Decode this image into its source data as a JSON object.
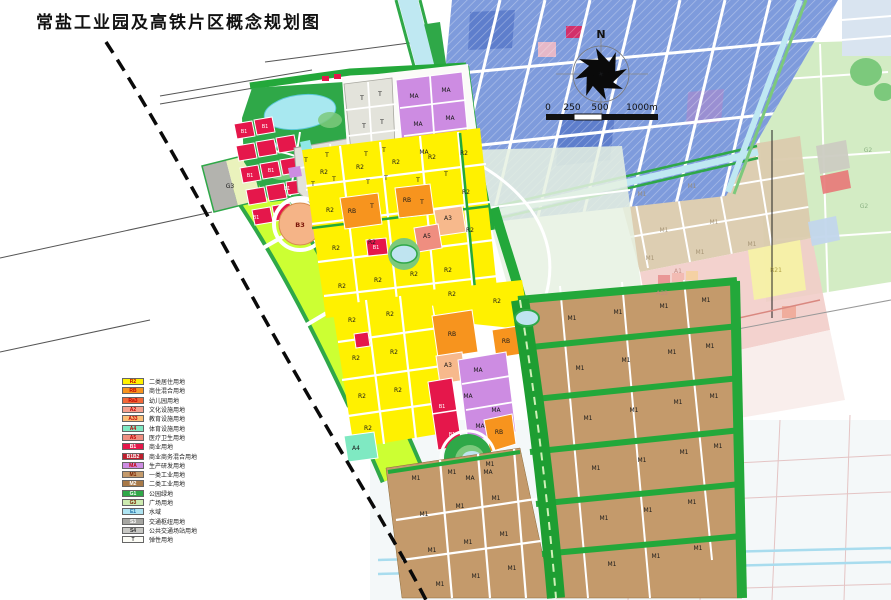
{
  "title": "常盐工业园及高铁片区概念规划图",
  "compass": {
    "label": "N"
  },
  "scale_bar": {
    "ticks": [
      "0",
      "250",
      "500",
      "1000m"
    ]
  },
  "legend": {
    "items": [
      {
        "code": "R2",
        "label": "二类居住用地",
        "fill": "#FFF100",
        "text": "#C00000"
      },
      {
        "code": "RB",
        "label": "商住混合用地",
        "fill": "#F7941E",
        "text": "#C00000"
      },
      {
        "code": "Ra3",
        "label": "幼儿园用地",
        "fill": "#F26838",
        "text": "#C00000"
      },
      {
        "code": "A2",
        "label": "文化设施用地",
        "fill": "#F5A08E",
        "text": "#C00000"
      },
      {
        "code": "A33",
        "label": "教育设施用地",
        "fill": "#FBBF77",
        "text": "#C00000"
      },
      {
        "code": "A4",
        "label": "体育设施用地",
        "fill": "#7FE9C2",
        "text": "#C00000"
      },
      {
        "code": "A5",
        "label": "医疗卫生用地",
        "fill": "#EF8E80",
        "text": "#C00000"
      },
      {
        "code": "B1",
        "label": "商业用地",
        "fill": "#E5174B",
        "text": "#FFFFFF"
      },
      {
        "code": "B1B2",
        "label": "商业商务混合用地",
        "fill": "#BE1E2D",
        "text": "#FFFFFF"
      },
      {
        "code": "MA",
        "label": "生产研发用地",
        "fill": "#CD8CE2",
        "text": "#C00000"
      },
      {
        "code": "M1",
        "label": "一类工业用地",
        "fill": "#C49A6B",
        "text": "#7A2000"
      },
      {
        "code": "M2",
        "label": "二类工业用地",
        "fill": "#A87948",
        "text": "#FFFFFF"
      },
      {
        "code": "G1",
        "label": "公园绿地",
        "fill": "#2FA848",
        "text": "#FFFFFF"
      },
      {
        "code": "G3",
        "label": "广场用地",
        "fill": "#CDEBB0",
        "text": "#7A2000"
      },
      {
        "code": "E1",
        "label": "水域",
        "fill": "#AEE4F2",
        "text": "#1F6FA8"
      },
      {
        "code": "S3",
        "label": "交通枢纽用地",
        "fill": "#A6A6A2",
        "text": "#FFFFFF"
      },
      {
        "code": "S4",
        "label": "公共交通场站用地",
        "fill": "#C8C8C4",
        "text": "#333333"
      },
      {
        "code": "T",
        "label": "弹性用地",
        "fill": "#FCFCF6",
        "text": "#333333"
      }
    ]
  },
  "map": {
    "colors": {
      "residential_yellow": "#FFF100",
      "mixed_orange": "#F7941E",
      "commercial_red": "#E5174B",
      "research_violet": "#CD8CE2",
      "industrial_tan": "#C49A6B",
      "park_green": "#2FA848",
      "belt_green": "#23A83A",
      "rail_buffer_chartreuse": "#CCFF33",
      "water_cyan": "#BFE8F2",
      "existing_city_blue": "#7E9BDC",
      "faded_tan": "#DBCBAE",
      "faded_pink": "#F2CDC9",
      "faded_green": "#CBE9BA"
    },
    "labels": [
      [
        "B1",
        244,
        133,
        "wh"
      ],
      [
        "B1",
        265,
        128,
        "wh"
      ],
      [
        "B1",
        250,
        177,
        "wh"
      ],
      [
        "B1",
        271,
        172,
        "wh"
      ],
      [
        "B1",
        256,
        219,
        "wh"
      ],
      [
        "B1",
        287,
        190,
        "wh"
      ],
      [
        "T",
        306,
        162
      ],
      [
        "T",
        327,
        157
      ],
      [
        "T",
        313,
        186
      ],
      [
        "T",
        334,
        181
      ],
      [
        "T",
        362,
        100
      ],
      [
        "T",
        380,
        96
      ],
      [
        "T",
        364,
        128
      ],
      [
        "T",
        382,
        124
      ],
      [
        "T",
        366,
        156
      ],
      [
        "T",
        384,
        152
      ],
      [
        "T",
        368,
        184
      ],
      [
        "T",
        386,
        180
      ],
      [
        "T",
        372,
        208
      ],
      [
        "MA",
        414,
        98
      ],
      [
        "MA",
        446,
        92
      ],
      [
        "MA",
        418,
        126
      ],
      [
        "MA",
        450,
        120
      ],
      [
        "MA",
        424,
        154
      ],
      [
        "T",
        418,
        182
      ],
      [
        "T",
        446,
        176
      ],
      [
        "T",
        422,
        204
      ],
      [
        "G3",
        230,
        188
      ],
      [
        "B3",
        300,
        227,
        "rd"
      ],
      [
        "RB",
        352,
        213
      ],
      [
        "RB",
        407,
        202
      ],
      [
        "RB",
        452,
        336
      ],
      [
        "RB",
        506,
        343
      ],
      [
        "RB",
        499,
        434
      ],
      [
        "R2",
        324,
        174
      ],
      [
        "R2",
        360,
        169
      ],
      [
        "R2",
        396,
        164
      ],
      [
        "R2",
        432,
        159
      ],
      [
        "R2",
        464,
        155
      ],
      [
        "R2",
        330,
        212
      ],
      [
        "R2",
        466,
        194
      ],
      [
        "R2",
        336,
        250
      ],
      [
        "R2",
        372,
        244
      ],
      [
        "R2",
        470,
        232
      ],
      [
        "R2",
        342,
        288
      ],
      [
        "R2",
        378,
        282
      ],
      [
        "R2",
        414,
        276
      ],
      [
        "R2",
        448,
        272
      ],
      [
        "A3",
        448,
        220
      ],
      [
        "A3",
        448,
        367
      ],
      [
        "A5",
        427,
        238
      ],
      [
        "B1",
        376,
        249,
        "wh"
      ],
      [
        "R2",
        352,
        322
      ],
      [
        "R2",
        390,
        316
      ],
      [
        "R2",
        356,
        360
      ],
      [
        "R2",
        394,
        354
      ],
      [
        "R2",
        362,
        398
      ],
      [
        "R2",
        398,
        392
      ],
      [
        "R2",
        368,
        430
      ],
      [
        "R2",
        497,
        303
      ],
      [
        "R2",
        452,
        296
      ],
      [
        "MA",
        478,
        372
      ],
      [
        "MA",
        468,
        398
      ],
      [
        "MA",
        496,
        412
      ],
      [
        "MA",
        480,
        428
      ],
      [
        "B1",
        442,
        408,
        "wh"
      ],
      [
        "B1",
        452,
        436,
        "wh"
      ],
      [
        "MA",
        470,
        480
      ],
      [
        "MA",
        488,
        474
      ],
      [
        "A4",
        356,
        450
      ],
      [
        "M1",
        416,
        480
      ],
      [
        "M1",
        452,
        474
      ],
      [
        "M1",
        490,
        466
      ],
      [
        "M1",
        424,
        516
      ],
      [
        "M1",
        460,
        508
      ],
      [
        "M1",
        496,
        500
      ],
      [
        "M1",
        432,
        552
      ],
      [
        "M1",
        468,
        544
      ],
      [
        "M1",
        504,
        536
      ],
      [
        "M1",
        440,
        586
      ],
      [
        "M1",
        476,
        578
      ],
      [
        "M1",
        512,
        570
      ],
      [
        "M1",
        572,
        320
      ],
      [
        "M1",
        618,
        314
      ],
      [
        "M1",
        664,
        308
      ],
      [
        "M1",
        706,
        302
      ],
      [
        "M1",
        580,
        370
      ],
      [
        "M1",
        626,
        362
      ],
      [
        "M1",
        672,
        354
      ],
      [
        "M1",
        710,
        348
      ],
      [
        "M1",
        588,
        420
      ],
      [
        "M1",
        634,
        412
      ],
      [
        "M1",
        678,
        404
      ],
      [
        "M1",
        714,
        398
      ],
      [
        "M1",
        596,
        470
      ],
      [
        "M1",
        642,
        462
      ],
      [
        "M1",
        684,
        454
      ],
      [
        "M1",
        718,
        448
      ],
      [
        "M1",
        604,
        520
      ],
      [
        "M1",
        648,
        512
      ],
      [
        "M1",
        692,
        504
      ],
      [
        "M1",
        612,
        566
      ],
      [
        "M1",
        656,
        558
      ],
      [
        "M1",
        698,
        550
      ],
      [
        "M1",
        642,
        196,
        "fd"
      ],
      [
        "M1",
        692,
        188,
        "fd"
      ],
      [
        "M1",
        664,
        232,
        "fd"
      ],
      [
        "M1",
        714,
        224,
        "fd"
      ],
      [
        "M1",
        650,
        260,
        "fd"
      ],
      [
        "M1",
        700,
        254,
        "fd"
      ],
      [
        "M1",
        752,
        246,
        "fd"
      ],
      [
        "G2",
        868,
        152,
        "fg"
      ],
      [
        "G2",
        864,
        208,
        "fg"
      ],
      [
        "R21",
        776,
        272,
        "fy"
      ],
      [
        "A33",
        662,
        295,
        "fp"
      ],
      [
        "A1",
        678,
        273,
        "fp"
      ]
    ]
  }
}
